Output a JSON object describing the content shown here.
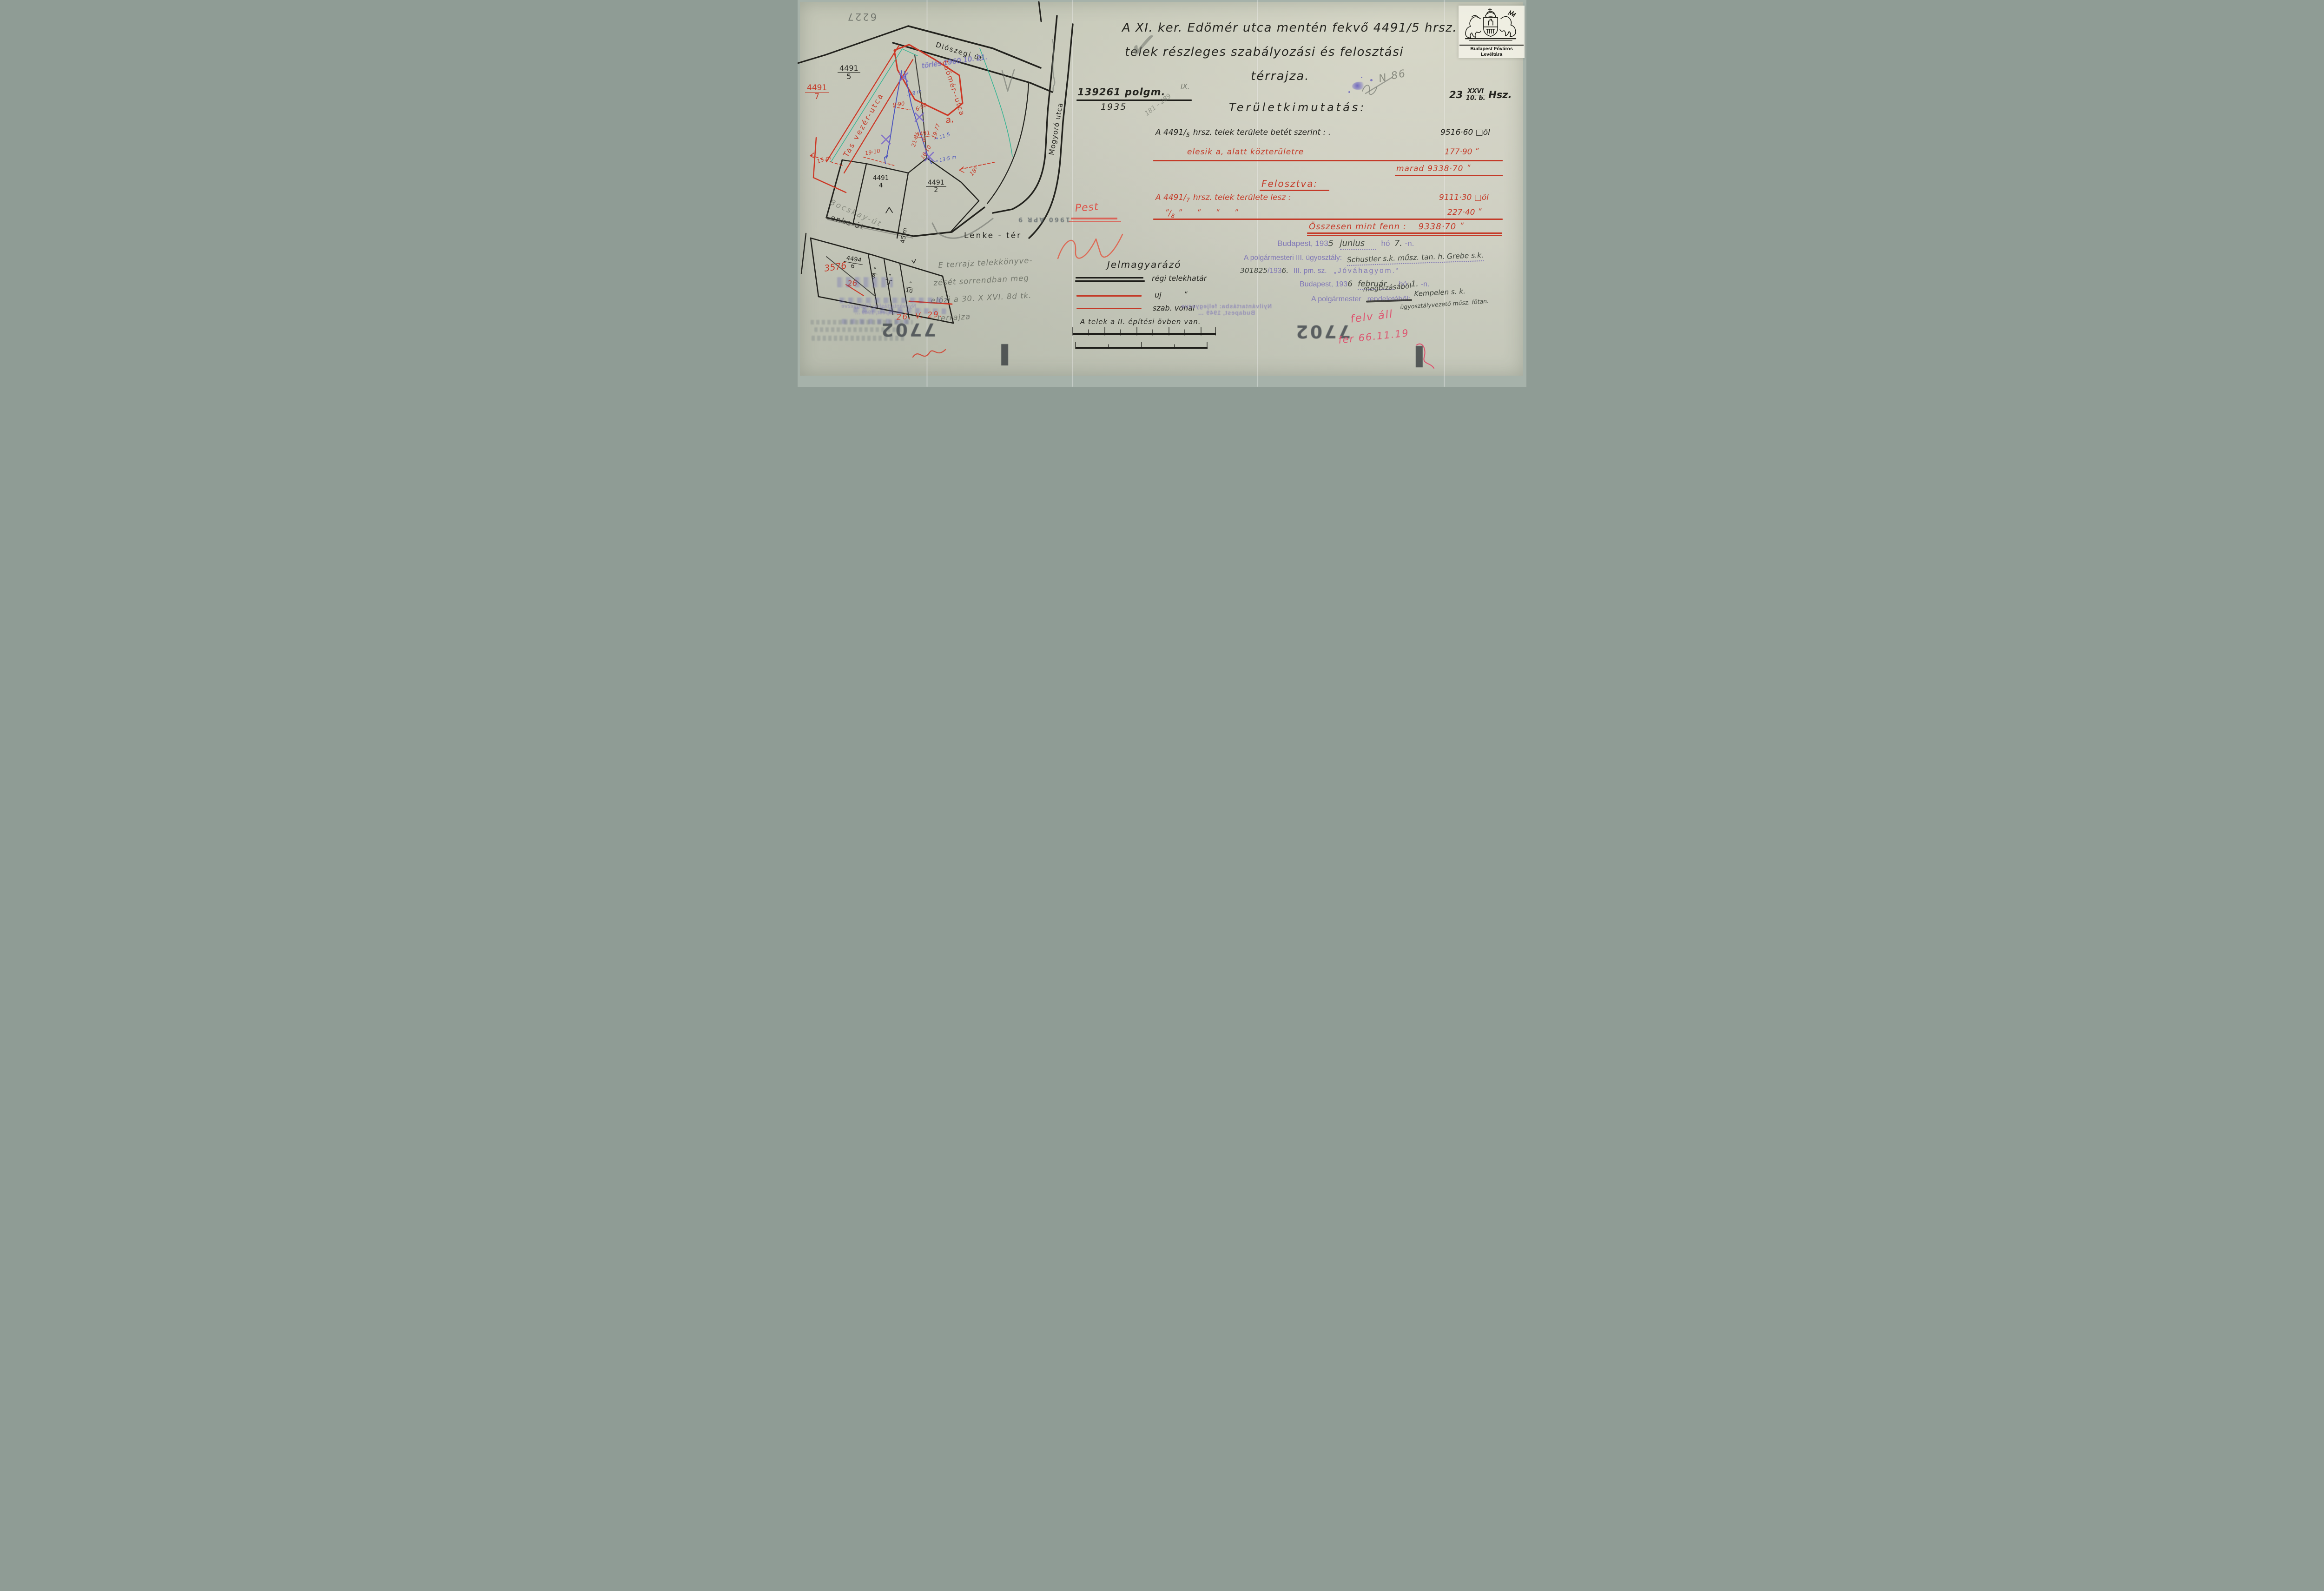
{
  "colors": {
    "paper": "#c7c9bc",
    "red_ink": "#c43a28",
    "purple_stamp": "#8078b6",
    "blue_ink": "#4a53bd",
    "teal_line": "#35b493",
    "black_ink": "#24241f",
    "pink_crayon": "#dd5570"
  },
  "logo": {
    "caption": "Budapest Főváros Levéltára"
  },
  "header": {
    "title_line1": "A XI. ker. Edömér utca mentén fekvő 4491/5 hrsz.",
    "title_line2": "telek részleges szabályozási és felosztási",
    "title_line3": "térrajza.",
    "file_number": "139261 polgm.",
    "file_number_suffix": "IX.",
    "file_year": "1935",
    "sheet_prefix": "23",
    "sheet_num": "XXVI",
    "sheet_den": "10. b.",
    "sheet_suffix": "Hsz."
  },
  "table": {
    "heading": "Területkimutatás:",
    "row1_num": "A 4491/",
    "row1_den": "5",
    "row1_text": "hrsz. telek területe betét szerint : .",
    "row1_value": "9516·60 □öl",
    "row2_label": "elesik a, alatt közterületre",
    "row2_value": "177·90 ʺ",
    "row3_label": "marad",
    "row3_value": "9338·70 ʺ",
    "subheading": "Felosztva:",
    "row4_num": "A 4491/",
    "row4_den": "7",
    "row4_text": "hrsz. telek területe lesz :",
    "row4_value": "9111·30 □öl",
    "row5_num": "ʺ/",
    "row5_den": "8",
    "row5_dittos": "ʺ      ʺ      ʺ      ʺ",
    "row5_value": "227·40 ʺ",
    "row6_label": "Összesen mint fenn :",
    "row6_value": "9338·70 ʺ"
  },
  "approval": {
    "l1_stamp_a": "Budapest, 193",
    "l1_year": "5",
    "l1_month": "junius",
    "l1_stamp_b": "hó",
    "l1_day": "7.",
    "l1_stamp_c": "-n.",
    "l2_stamp": "A polgármesteri III. ügyosztály:",
    "l2_hand": "Schustler s.k. műsz. tan. h.  Grebe s.k.",
    "l3_hand_no": "301825",
    "l3_stamp_a": "/193",
    "l3_hand_year": "6.",
    "l3_stamp_b": "III. pm. sz.",
    "l3_quote": "„Jóváhagyom.“",
    "l4_stamp_a": "Budapest, 193",
    "l4_year": "6",
    "l4_month": "február",
    "l4_stamp_b": "hó",
    "l4_day": "1.",
    "l4_stamp_c": "-n.",
    "l5_stamp": "A polgármester",
    "l5_crossed": "rendeletéből:",
    "l5_hand": "megbízásából",
    "l5_sign": "Kempelen s. k.",
    "l5_sign_title": "ügyosztályvezető műsz. főtan."
  },
  "legend": {
    "heading": "Jelmagyarázó",
    "item1": "régi telekhatár",
    "item2a": "uj",
    "item2b": "ʺ",
    "item3": "szab. vonal",
    "zone_note": "A telek a II. építési övben van."
  },
  "map": {
    "streets": {
      "dioszegi": "Diószegi út",
      "tas": "Tas vezér-utca",
      "edomer": "Edömér--utca",
      "mogyoro": "Mogyoró utca",
      "bocskay": "Bocskay-út",
      "lenke_ut": "Lenke-út",
      "lenke_ter": "Lenke - tér"
    },
    "parcels": {
      "p5n": "4491",
      "p5d": "5",
      "p7n": "4491",
      "p7d": "7",
      "p8n": "4491",
      "p8d": "8",
      "p4n": "4491",
      "p4d": "4",
      "p2n": "4491",
      "p2d": "2",
      "s6n": "4494",
      "s6d": "6",
      "s8n": "ʺ",
      "s8d": "8",
      "s9n": "ʺ",
      "s9d": "9",
      "s10n": "ʺ",
      "s10d": "10"
    },
    "labels": {
      "a": "a,",
      "d45": "45 m",
      "check": "✓"
    },
    "red_measures": {
      "m990": "9·90",
      "m690": "6·90",
      "m1977": "19·77",
      "m2181": "21·81",
      "m1910": "19·10",
      "m1610": "16·10",
      "m15": "15 m",
      "m18": "18⁰"
    },
    "blue_measures": {
      "b9": "→ 9 m",
      "b115": "→ 11·5",
      "b135": "→ 13·5 m"
    },
    "old_numbers": {
      "a": "3576",
      "b": "26"
    },
    "blue_note": "törlés 1960.10. 21.",
    "mirror_plate": "6227"
  },
  "annotations": {
    "pencil_note": [
      "E terrajz telekkönyve-",
      "zését sorrendban meg",
      "előzi a 30. X XVI. 8d tk.",
      "terrajza"
    ],
    "pencil_range": "181 - 289",
    "pencil_no": "N 86",
    "red_date": "26. V. 29.",
    "red_note1": "felv áll",
    "red_note2": "fer 66.11.19",
    "pest": "Pest"
  },
  "stamps": {
    "registry1": "Nyilvántartásba: feljegyezve",
    "registry2": "Budapest, 1949 …",
    "n7702": "7702",
    "d1960": "1960 ÁPR 9"
  }
}
